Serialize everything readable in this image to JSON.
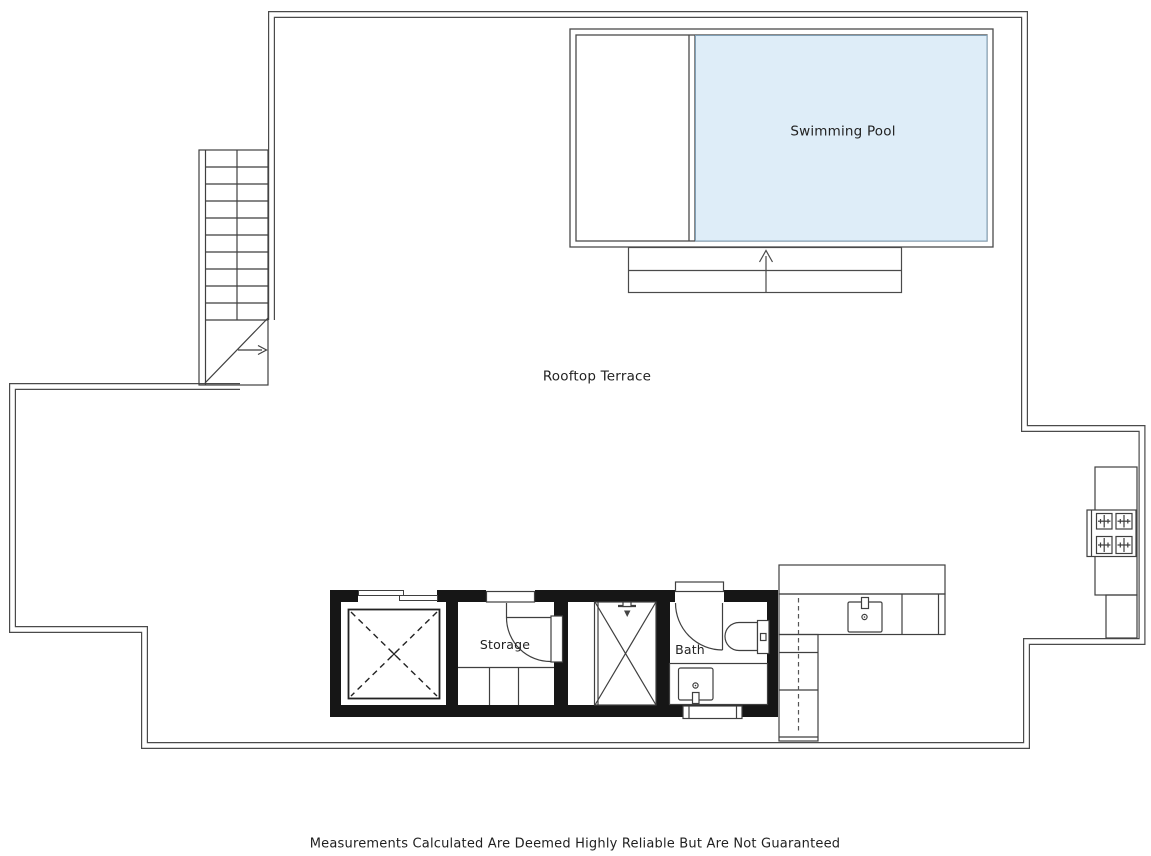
{
  "plan": {
    "labels": {
      "swimming_pool": "Swimming Pool",
      "rooftop_terrace": "Rooftop Terrace",
      "storage": "Storage",
      "bath": "Bath"
    },
    "fixtures": [
      "staircase-icon",
      "stair-direction-arrow-icon",
      "pool-entry-arrow-icon",
      "elevator-shaft-icon",
      "storage-door-icon",
      "storage-shelves-icon",
      "shower-tray-icon",
      "shower-head-icon",
      "bath-door-icon",
      "toilet-icon",
      "bath-sink-icon",
      "towel-radiator-icon",
      "kitchen-sink-icon",
      "kitchen-counter-icon",
      "bbq-hob-icon"
    ],
    "colors": {
      "pool_fill": "#deedf8",
      "pool_stroke": "#7f9fb6",
      "wall_line": "#4a4a4a",
      "solid_wall": "#161616",
      "thin_line": "#3f3f3f"
    }
  },
  "footer": {
    "disclaimer": "Measurements Calculated Are Deemed Highly Reliable But Are Not Guaranteed"
  }
}
